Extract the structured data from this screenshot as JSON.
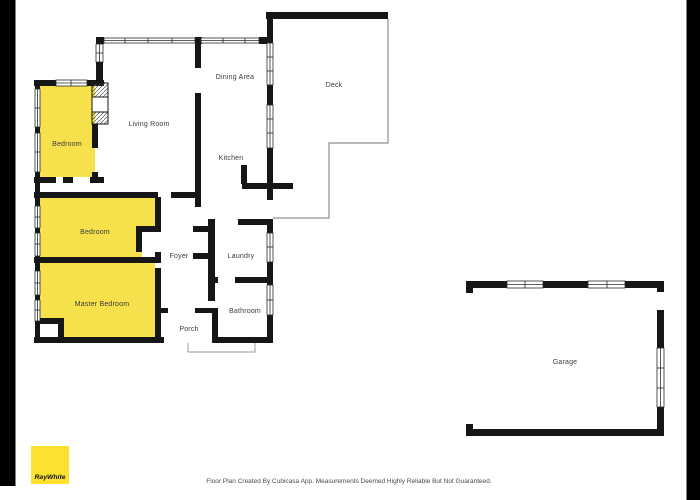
{
  "colors": {
    "highlight": "#F6E04B",
    "logo_yellow": "#FCE22E",
    "wall": "#161616",
    "label": "#3C3C3C",
    "frame": "#000000",
    "deck_outline": "#8F8F8F",
    "background": "#FFFFFF"
  },
  "rooms": [
    {
      "label": "Bedroom",
      "highlighted": true
    },
    {
      "label": "Living Room",
      "highlighted": false
    },
    {
      "label": "Dining Area",
      "highlighted": false
    },
    {
      "label": "Kitchen",
      "highlighted": false
    },
    {
      "label": "Deck",
      "highlighted": false
    },
    {
      "label": "Bedroom",
      "highlighted": true
    },
    {
      "label": "Master Bedroom",
      "highlighted": true
    },
    {
      "label": "Foyer",
      "highlighted": false
    },
    {
      "label": "Laundry",
      "highlighted": false
    },
    {
      "label": "Bathroom",
      "highlighted": false
    },
    {
      "label": "Porch",
      "highlighted": false
    },
    {
      "label": "Garage",
      "highlighted": false
    }
  ],
  "branding": {
    "logo_text": "RayWhite"
  },
  "footer": {
    "disclaimer": "Floor Plan Created By Cubicasa App. Measurements Deemed Highly Reliable But Not Guaranteed."
  }
}
